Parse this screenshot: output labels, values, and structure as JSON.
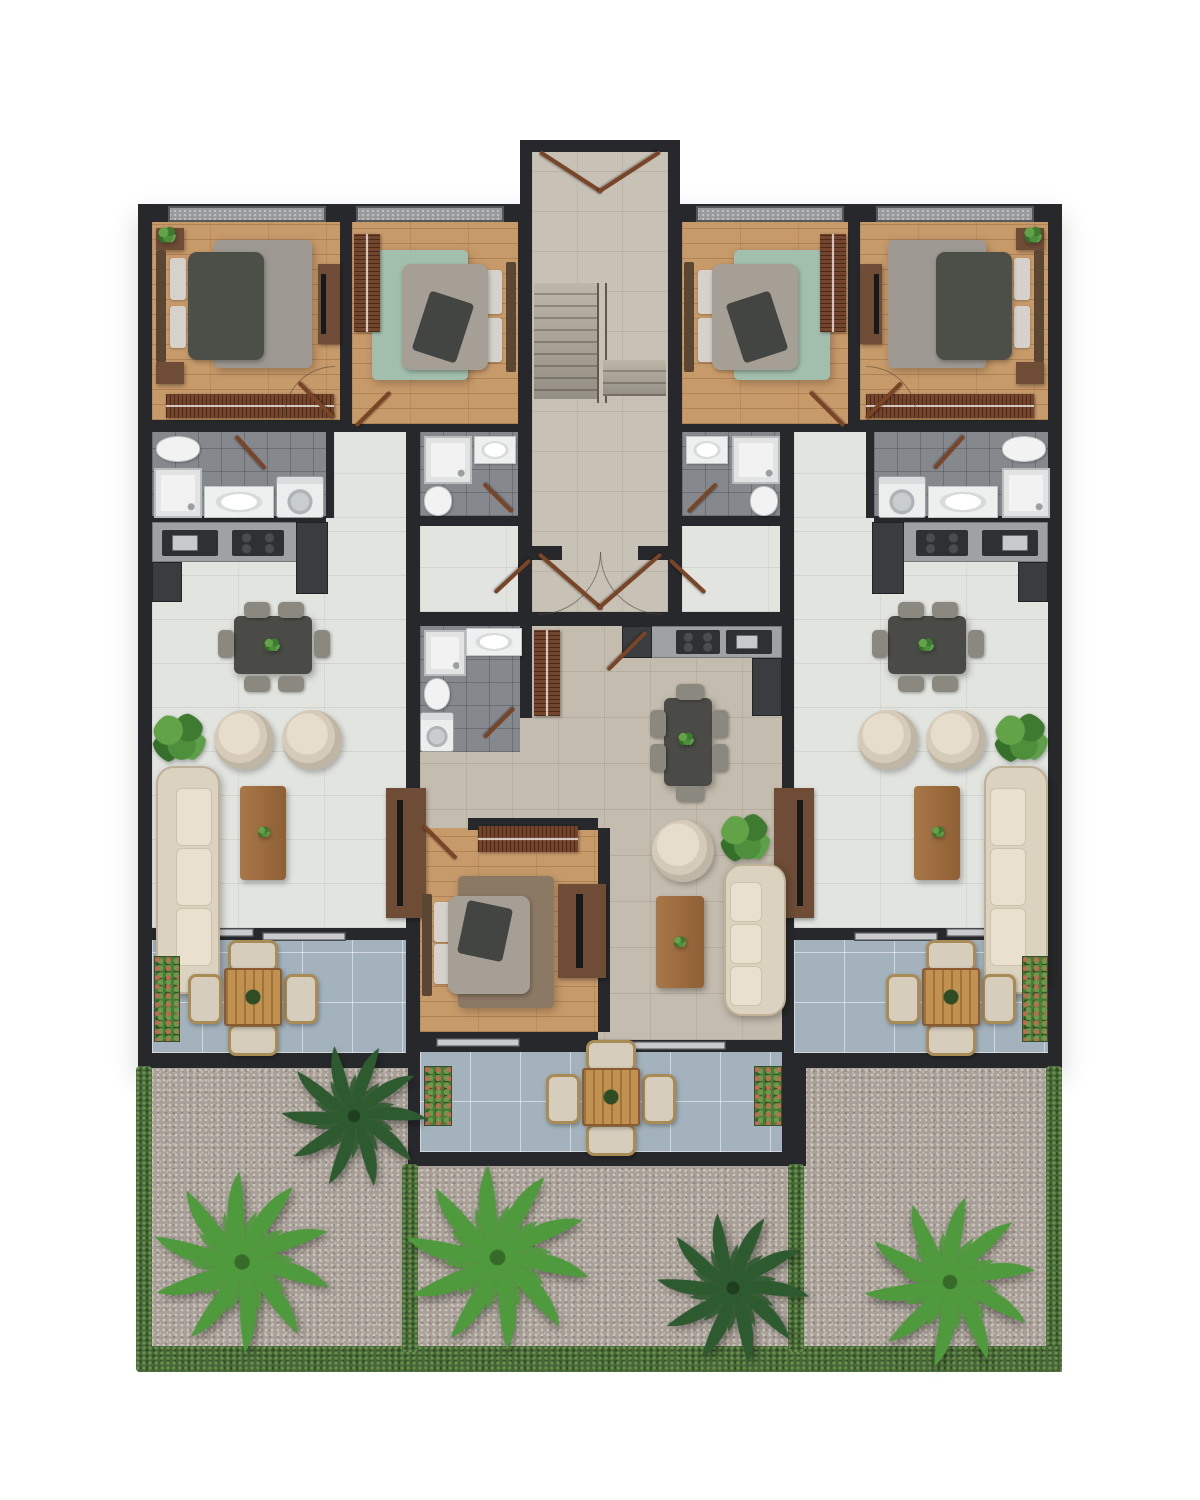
{
  "palette": {
    "wall": "#26282b",
    "woodFloor": "#c79a6a",
    "tileLiving": "#e2e4e0",
    "tileCenter": "#c4bcae",
    "tileStair": "#c8c2b6",
    "tileBath": "#85888c",
    "tileBalcony": "#a3b2bc",
    "gravel": "#a9a199",
    "hedge": "#47663a",
    "sofaCream": "#dcd2c0",
    "sofaEdge": "#bfb098",
    "armchair": "#d6cbb8",
    "tableDark": "#4a4a46",
    "chairGray": "#8b8880",
    "wardrobe": "#74452d",
    "consoleWood": "#6e4c36",
    "bedDark": "#4c4f47",
    "bedLight": "#a59f96",
    "pillow": "#d6d2cb",
    "rugGray": "#9d9992",
    "rugTeal": "#a2bfae",
    "rugBrown": "#8c7964",
    "counter": "#9fa1a3",
    "appliance": "#2e3032",
    "fixture": "#f1f2f1",
    "doorLeaf": "#7a4526",
    "palmBright": "#4f9a3c",
    "palmDark": "#2d5a2e",
    "planter": "#4e7a38",
    "outChair": "#d6cdbc",
    "outWood": "#c0914f"
  },
  "scene": {
    "type": "architectural-floor-plan",
    "view": "top-down 3D rendered floor plan, no text labels",
    "background": "#ffffff",
    "units": [
      {
        "id": "left-apartment",
        "rooms": [
          "bedroom-1",
          "bedroom-2",
          "bathroom-left",
          "bathroom-bedroom-2",
          "open-living-dining-kitchen-left",
          "balcony-left"
        ]
      },
      {
        "id": "center-apartment",
        "rooms": [
          "bathroom-center",
          "bedroom-center",
          "open-living-dining-kitchen-center",
          "balcony-center"
        ]
      },
      {
        "id": "right-apartment",
        "rooms": [
          "bedroom-3",
          "bedroom-4",
          "bathroom-bedroom-3",
          "bathroom-right",
          "open-living-dining-kitchen-right",
          "balcony-right"
        ]
      }
    ],
    "common_areas": [
      "entrance-stair-hall",
      "gravel-garden"
    ],
    "rooms": {
      "stair-hall": [
        "double-entry-doors",
        "staircase-two-flights",
        "center-handrail",
        "double-doors-to-units"
      ],
      "bedroom-1": [
        "double-bed-dark-bedding",
        "two-nightstands",
        "gray-rug",
        "tv-console",
        "slatted-wardrobe",
        "potted-plant"
      ],
      "bedroom-2": [
        "double-bed-gray-bedding",
        "teal-rug",
        "slatted-wardrobe",
        "dark-throw"
      ],
      "bedroom-3": [
        "double-bed-gray-bedding",
        "teal-rug",
        "slatted-wardrobe",
        "dark-throw"
      ],
      "bedroom-4": [
        "double-bed-dark-bedding",
        "two-nightstands",
        "gray-rug",
        "tv-console",
        "slatted-wardrobe",
        "potted-plant"
      ],
      "bedroom-center": [
        "double-bed-gray-bedding",
        "brown-rug",
        "slatted-wardrobe",
        "wall-tv-panel"
      ],
      "bathrooms": [
        "toilet",
        "shower-tray",
        "washbasin-counter",
        "washing-machine"
      ],
      "open-living-dining-kitchen-left": [
        "kitchen-counter-sink-cooktop",
        "dining-table-6-chairs",
        "two-round-armchairs",
        "chesterfield-sofa",
        "wood-coffee-table",
        "tv-console",
        "potted-plant"
      ],
      "open-living-dining-kitchen-right": [
        "kitchen-counter-sink-cooktop",
        "dining-table-6-chairs",
        "two-round-armchairs",
        "chesterfield-sofa",
        "wood-coffee-table",
        "tv-console",
        "potted-plant"
      ],
      "open-living-dining-kitchen-center": [
        "kitchen-counter-sink-cooktop",
        "dining-table-6-chairs",
        "round-armchair",
        "chesterfield-sofa",
        "wood-coffee-table",
        "potted-plant",
        "corridor-wardrobe"
      ],
      "balcony-left": [
        "outdoor-table-4-chairs",
        "planter-box"
      ],
      "balcony-right": [
        "outdoor-table-4-chairs",
        "planter-box"
      ],
      "balcony-center": [
        "outdoor-table-4-chairs",
        "two-planter-boxes"
      ],
      "gravel-garden": [
        "hedge-borders",
        "two-hedge-dividers",
        "three-bright-palms",
        "two-dark-palms"
      ]
    },
    "counts": {
      "bedrooms": 5,
      "bathrooms": 4,
      "washing_machines": 3,
      "balconies": 3,
      "outdoor_dining_sets": 3,
      "sofas": 3,
      "dining_tables": 3,
      "palm_trees": 5
    }
  }
}
